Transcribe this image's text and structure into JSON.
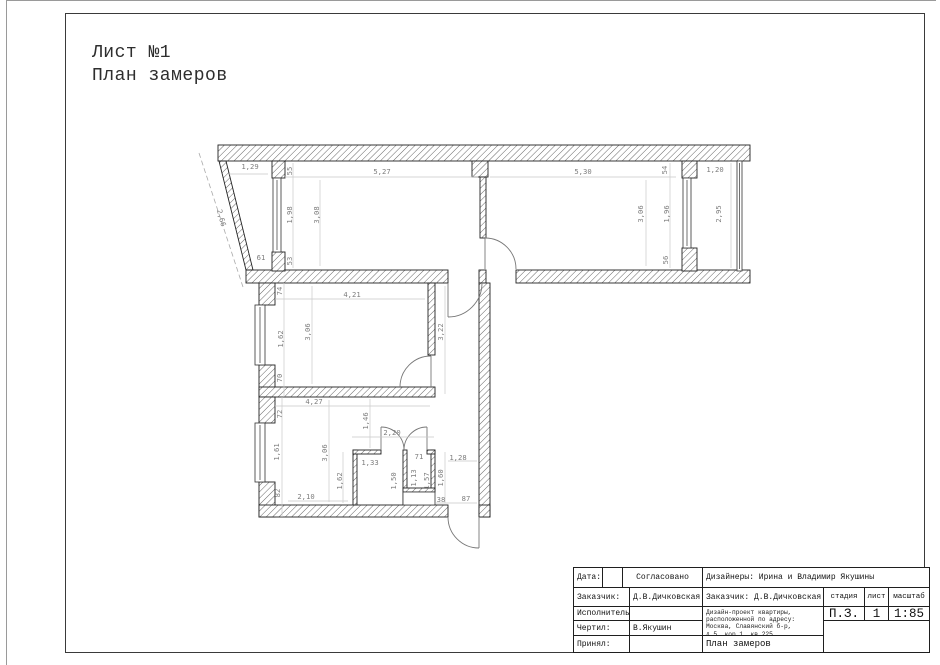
{
  "page": {
    "title_line1": "Лист №1",
    "title_line2": "План замеров"
  },
  "plan": {
    "dimensions": [
      {
        "label": "1,29"
      },
      {
        "label": "2,66"
      },
      {
        "label": "61"
      },
      {
        "label": "55"
      },
      {
        "label": "1,98"
      },
      {
        "label": "53"
      },
      {
        "label": "5,27"
      },
      {
        "label": "3,08"
      },
      {
        "label": "5,30"
      },
      {
        "label": "3,06"
      },
      {
        "label": "54"
      },
      {
        "label": "1,96"
      },
      {
        "label": "56"
      },
      {
        "label": "1,20"
      },
      {
        "label": "2,95"
      },
      {
        "label": "74"
      },
      {
        "label": "4,21"
      },
      {
        "label": "1,62"
      },
      {
        "label": "3,06"
      },
      {
        "label": "3,22"
      },
      {
        "label": "70"
      },
      {
        "label": "4,27"
      },
      {
        "label": "72"
      },
      {
        "label": "1,46"
      },
      {
        "label": "2,20"
      },
      {
        "label": "1,61"
      },
      {
        "label": "3,06"
      },
      {
        "label": "1,33"
      },
      {
        "label": "71"
      },
      {
        "label": "1,28"
      },
      {
        "label": "1,62"
      },
      {
        "label": "1,50"
      },
      {
        "label": "1,13"
      },
      {
        "label": "1,57"
      },
      {
        "label": "1,60"
      },
      {
        "label": "82"
      },
      {
        "label": "2,10"
      },
      {
        "label": "38"
      },
      {
        "label": "87"
      }
    ]
  },
  "title_block": {
    "rows": [
      {
        "label": "Дата:",
        "value": ""
      },
      {
        "label": "Заказчик:",
        "value": "Д.В.Дичковская"
      },
      {
        "label": "Исполнитель:",
        "value": ""
      },
      {
        "label": "Чертил:",
        "value": "В.Якушин"
      },
      {
        "label": "Принял:",
        "value": ""
      }
    ],
    "approved": "Согласовано",
    "designers": "Дизайнеры: Ирина и Владимир Якушины",
    "client": "Заказчик: Д.В.Дичковская",
    "stage_label": "стадия",
    "sheet_label": "лист",
    "scale_label": "масштаб",
    "stage": "П.З.",
    "sheet": "1",
    "scale": "1:85",
    "project_lines": [
      "Дизайн-проект квартиры,",
      "расположенной по адресу:",
      "Москва, Славянский б-р,",
      "д.5, кор.1, кв.225"
    ],
    "doc_title": "План замеров"
  }
}
